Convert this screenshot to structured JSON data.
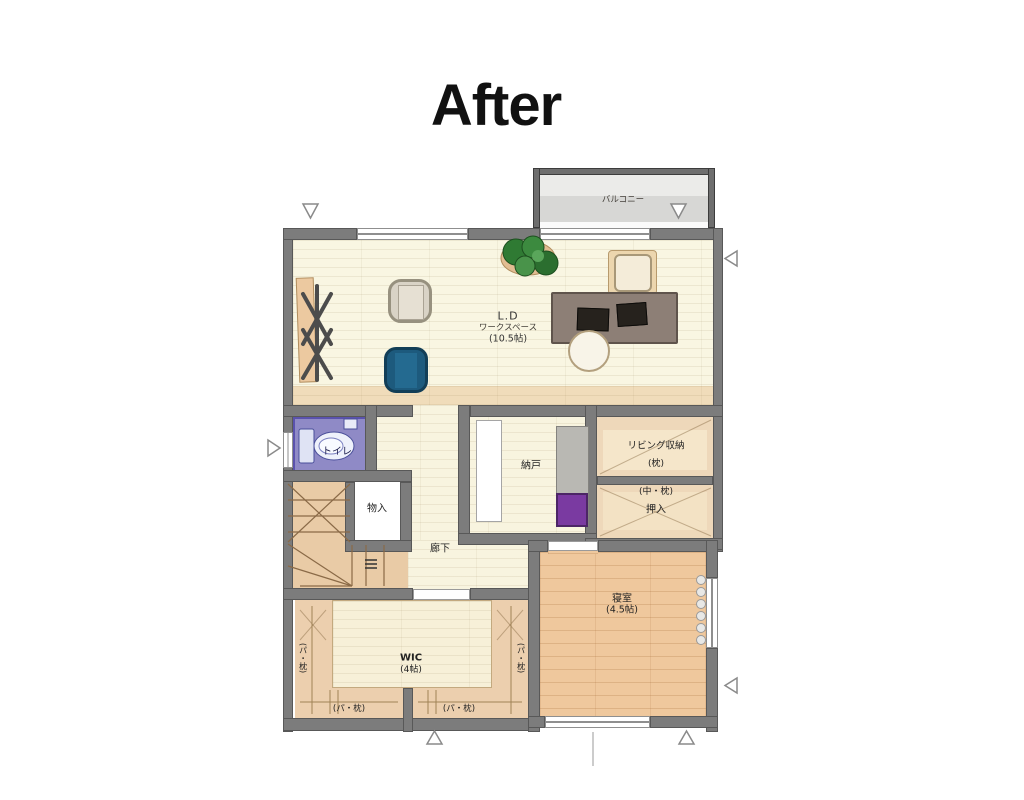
{
  "title": "After",
  "plan": {
    "balcony": {
      "label": "バルコニー"
    },
    "ld": {
      "line1": "L.D",
      "line2": "ワークスペース",
      "line3": "(10.5帖)"
    },
    "toilet": {
      "label": "トイレ"
    },
    "storage_small": {
      "label": "物入"
    },
    "nando": {
      "label": "納戸"
    },
    "hallway": {
      "label": "廊下"
    },
    "living_storage": {
      "line1": "リビング収納",
      "line2": "(枕)"
    },
    "oshiire": {
      "line1": "(中・枕)",
      "line2": "押入"
    },
    "bedroom": {
      "line1": "寝室",
      "line2": "(4.5帖)"
    },
    "wic": {
      "line1": "WIC",
      "line2": "(4帖)",
      "left": "(パ・枕)",
      "right": "(パ・枕)",
      "bottom_left": "(パ・枕)",
      "bottom_right": "(パ・枕)"
    }
  },
  "colors": {
    "wall": "#7c7c7c",
    "wall_outline": "#585858",
    "balcony_frame": "#6e6e6e",
    "floor_ld": "#f9f6e2",
    "floor_tan": "#f0dcba",
    "floor_storage": "#eed8ba",
    "floor_bedroom": "#efc89d",
    "floor_wic_band": "#eccfae",
    "floor_wic_inner": "#f7f0d8",
    "toilet_purple": "#8f8ac6",
    "chair_blue": "#1d5a7d",
    "chair_gray": "#d9d3c6",
    "desk_brown": "#8d7f76",
    "cabinet_gray": "#b9b8b3",
    "box_purple": "#7a3aa1",
    "plant_green": "#2f7a33"
  }
}
